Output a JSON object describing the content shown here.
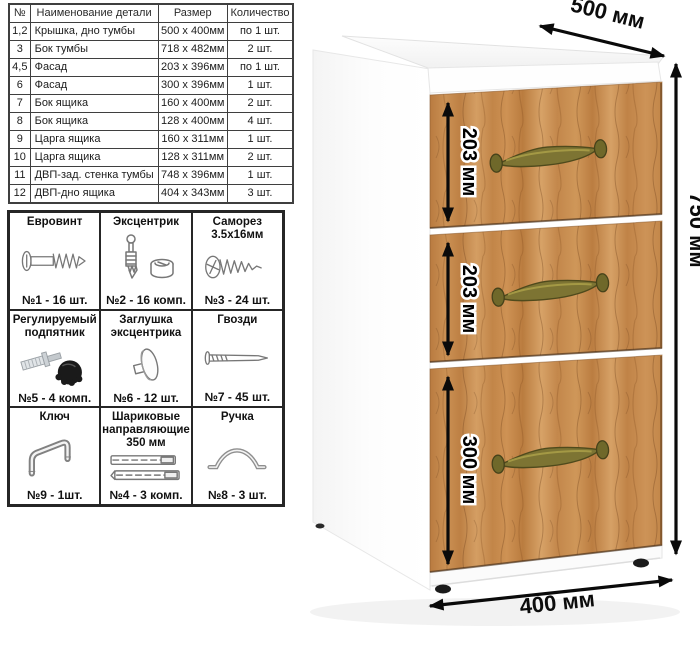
{
  "parts_table": {
    "headers": [
      "№",
      "Наименование детали",
      "Размер",
      "Количество"
    ],
    "rows": [
      [
        "1,2",
        "Крышка, дно тумбы",
        "500 х 400мм",
        "по 1 шт."
      ],
      [
        "3",
        "Бок тумбы",
        "718 х 482мм",
        "2 шт."
      ],
      [
        "4,5",
        "Фасад",
        "203 х 396мм",
        "по 1 шт."
      ],
      [
        "6",
        "Фасад",
        "300 х 396мм",
        "1 шт."
      ],
      [
        "7",
        "Бок ящика",
        "160 х 400мм",
        "2 шт."
      ],
      [
        "8",
        "Бок ящика",
        "128 х 400мм",
        "4 шт."
      ],
      [
        "9",
        "Царга ящика",
        "160 х 311мм",
        "1 шт."
      ],
      [
        "10",
        "Царга ящика",
        "128 х 311мм",
        "2 шт."
      ],
      [
        "11",
        "ДВП-зад. стенка тумбы",
        "748 х 396мм",
        "1 шт."
      ],
      [
        "12",
        "ДВП-дно ящика",
        "404 х 343мм",
        "3 шт."
      ]
    ]
  },
  "hardware": [
    {
      "name": "Евровинт",
      "count": "№1 - 16 шт.",
      "icon": "euro-screw-icon"
    },
    {
      "name": "Эксцентрик",
      "count": "№2 - 16 комп.",
      "icon": "cam-lock-icon"
    },
    {
      "name": "Саморез 3.5х16мм",
      "count": "№3 - 24 шт.",
      "icon": "self-tapping-screw-icon"
    },
    {
      "name": "Регулируемый подпятник",
      "count": "№5 - 4 комп.",
      "icon": "adjustable-foot-icon"
    },
    {
      "name": "Заглушка эксцентрика",
      "count": "№6 - 12 шт.",
      "icon": "cam-cap-icon"
    },
    {
      "name": "Гвозди",
      "count": "№7 - 45 шт.",
      "icon": "nail-icon"
    },
    {
      "name": "Ключ",
      "count": "№9 - 1шт.",
      "icon": "hex-key-icon"
    },
    {
      "name": "Шариковые направляющие 350 мм",
      "count": "№4 - 3 комп.",
      "icon": "ball-slides-icon"
    },
    {
      "name": "Ручка",
      "count": "№8 - 3 шт.",
      "icon": "handle-icon"
    }
  ],
  "dimensions": {
    "width_label": "500 мм",
    "height_label": "750 мм",
    "depth_label": "400 мм",
    "drawer_labels": [
      "203 мм",
      "203 мм",
      "300 мм"
    ]
  },
  "colors": {
    "wood": "#c68a4e",
    "handle_brass": "#7d7433",
    "carcass": "#ffffff",
    "dimension_text": "#0c0c0c",
    "table_border": "#3f3f3f"
  }
}
